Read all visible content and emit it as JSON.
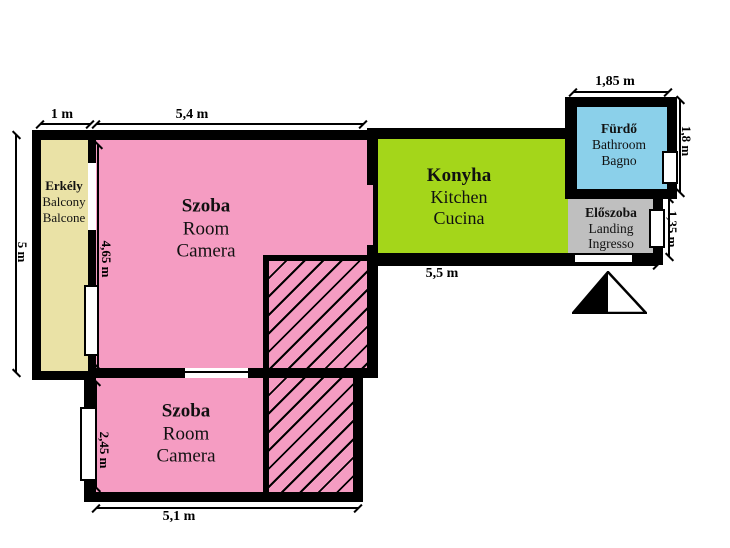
{
  "colors": {
    "wall": "#000000",
    "balcony": "#EAE2A6",
    "room": "#F59CC2",
    "kitchen": "#A4D61A",
    "bathroom": "#8BD0EA",
    "landing": "#BFBFBF",
    "window": "#ffffff",
    "background": "#ffffff"
  },
  "rooms": [
    {
      "id": "balcony",
      "name": "Erkély",
      "name_en": "Balcony",
      "name_it": "Balcone"
    },
    {
      "id": "room-upper",
      "name": "Szoba",
      "name_en": "Room",
      "name_it": "Camera"
    },
    {
      "id": "kitchen",
      "name": "Konyha",
      "name_en": "Kitchen",
      "name_it": "Cucina"
    },
    {
      "id": "bathroom",
      "name": "Fürdő",
      "name_en": "Bathroom",
      "name_it": "Bagno"
    },
    {
      "id": "landing",
      "name": "Előszoba",
      "name_en": "Landing",
      "name_it": "Ingresso"
    },
    {
      "id": "room-lower",
      "name": "Szoba",
      "name_en": "Room",
      "name_it": "Camera"
    }
  ],
  "dimensions": {
    "balcony_width": "1 m",
    "room_upper_width": "5,4 m",
    "bathroom_width": "1,85 m",
    "bathroom_height": "1,8 m",
    "left_side_height": "5 m",
    "room_upper_height": "4,65 m",
    "kitchen_entry_width": "5,5 m",
    "landing_height": "1,35 m",
    "room_lower_height": "2,45 m",
    "room_lower_width": "5,1 m"
  },
  "icons": {
    "north_arrow": "north-arrow-icon"
  }
}
